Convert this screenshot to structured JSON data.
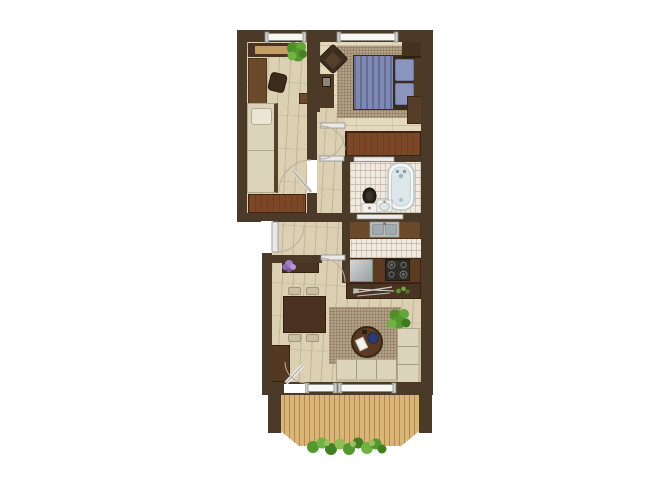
{
  "title": "two-room-apartment-floor-plan",
  "canvas": {
    "width": 667,
    "height": 500
  },
  "palette": {
    "wall": "#4b3a28",
    "wood": "#dbd0b2",
    "wood2": "#e3d9bd",
    "tile": "#efe9df",
    "rug": "#b3a287",
    "deck": "#d9b578",
    "cream": "#dcd3bb",
    "blue": "#7f89b2",
    "blue2": "#8a94bd",
    "steel": "#b4babb",
    "redwood": "#7c4726",
    "furn": "#4a3322",
    "furn2": "#6b4a2c",
    "green": "#55982f",
    "purple": "#9f7fc5"
  },
  "rooms": [
    {
      "name": "office-bedroom",
      "furniture": [
        "wardrobe",
        "desk",
        "office-chair",
        "plant",
        "single-bed",
        "low-cabinet"
      ]
    },
    {
      "name": "master-bedroom",
      "furniture": [
        "armchair",
        "nightstand",
        "double-bed",
        "pillows",
        "rug",
        "shelf",
        "dresser",
        "wardrobe"
      ]
    },
    {
      "name": "bathroom",
      "furniture": [
        "bathtub",
        "toilet",
        "washbasin"
      ]
    },
    {
      "name": "kitchen",
      "furniture": [
        "sink-counter",
        "refrigerator",
        "cooktop",
        "cutlery-console"
      ]
    },
    {
      "name": "hallway",
      "furniture": [
        "flower-shelf"
      ]
    },
    {
      "name": "living-room",
      "furniture": [
        "dining-table",
        "four-chairs",
        "side-cabinet",
        "rug",
        "round-coffee-table",
        "corner-sofa",
        "plant"
      ]
    },
    {
      "name": "balcony",
      "furniture": [
        "wood-deck",
        "flower-planter"
      ]
    }
  ],
  "openings": {
    "windows": 4,
    "interior_doors": 4,
    "entrance_doors": 1,
    "balcony_doors": 1
  }
}
